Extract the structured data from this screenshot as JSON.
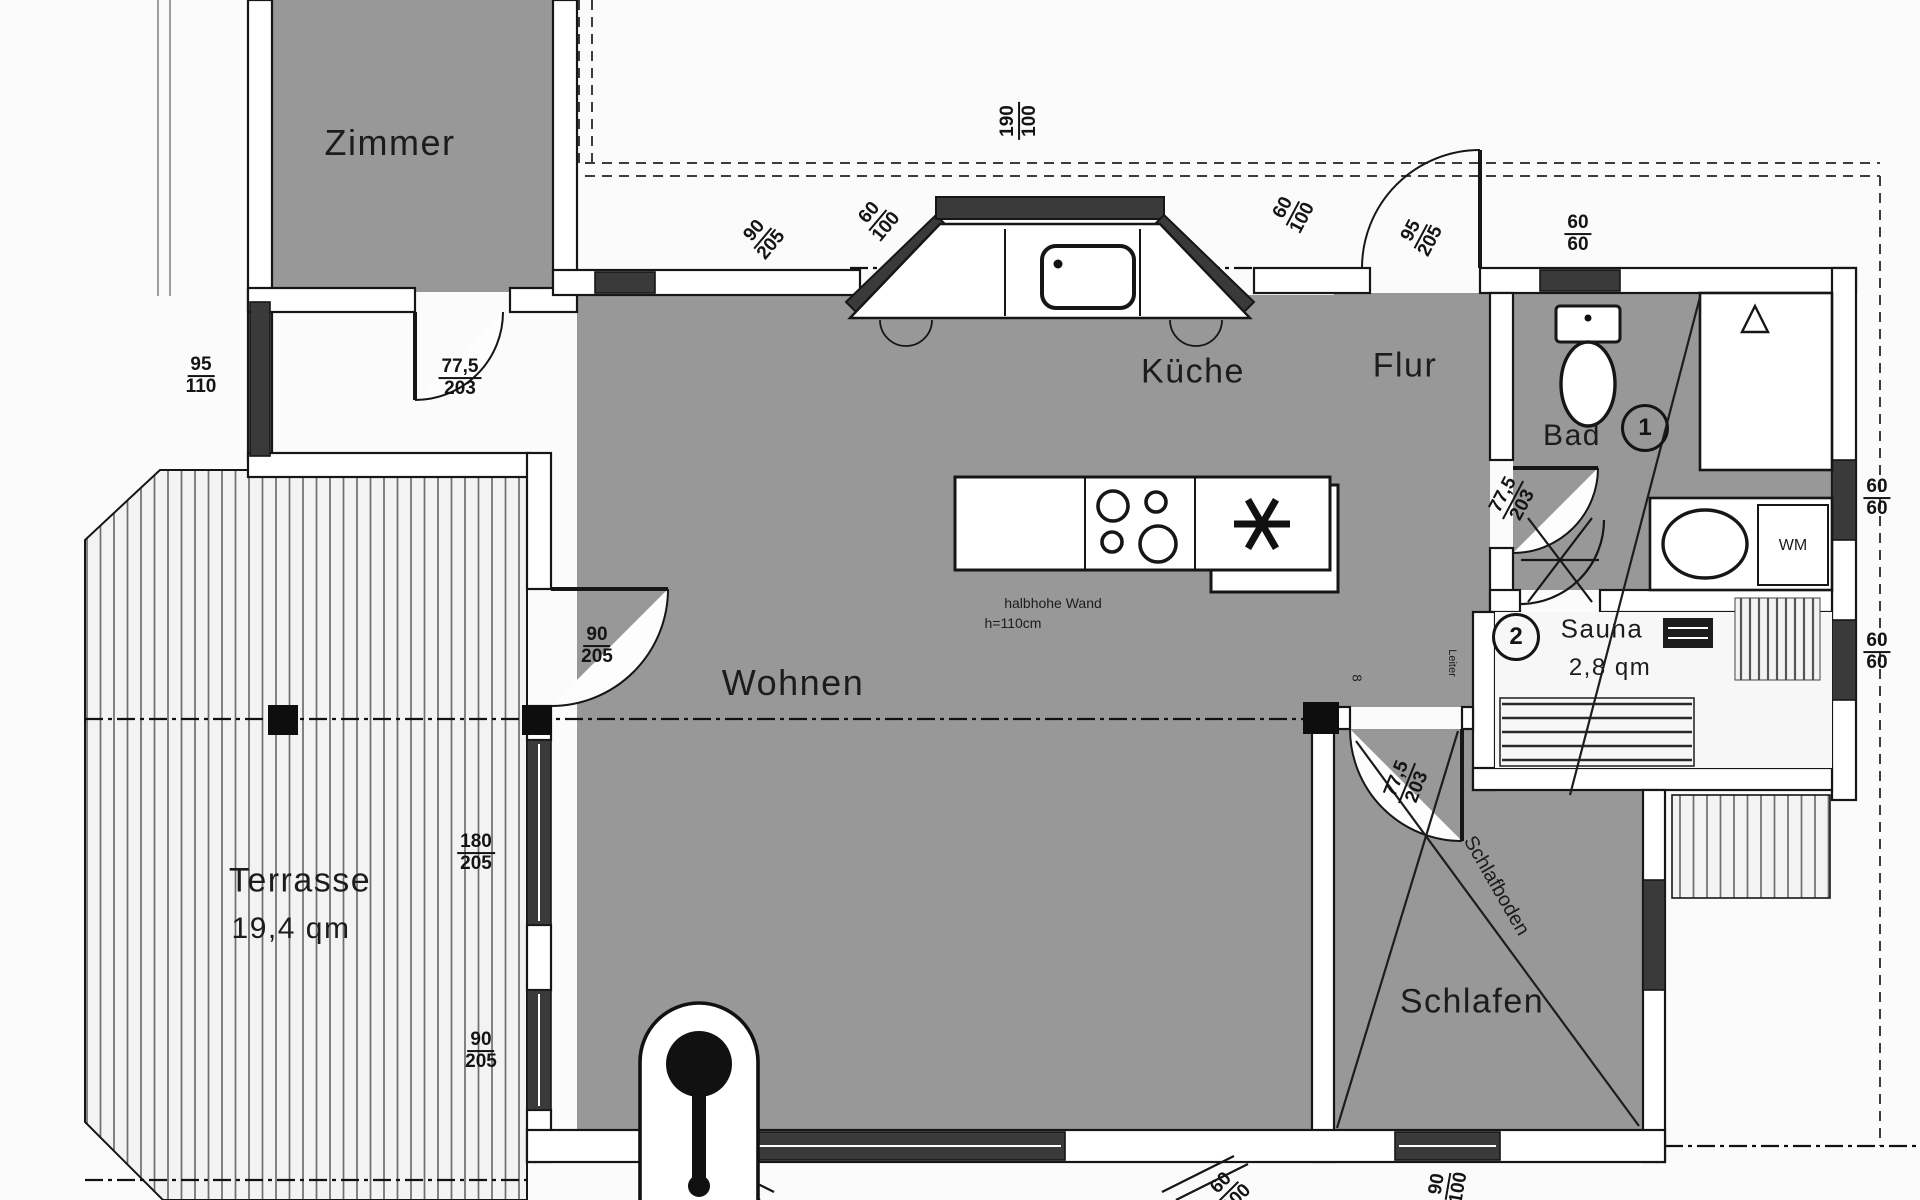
{
  "plan": {
    "colors": {
      "floor": "#989898",
      "wall_fill": "#ffffff",
      "line": "#161616",
      "window_fill": "#3a3a3a",
      "background": "#fbfbfb"
    },
    "rooms": [
      {
        "t": "Zimmer",
        "x": 390,
        "y": 143,
        "fs": 36
      },
      {
        "t": "Küche",
        "x": 1193,
        "y": 372,
        "fs": 34
      },
      {
        "t": "Flur",
        "x": 1405,
        "y": 366,
        "fs": 34
      },
      {
        "t": "Bad",
        "x": 1572,
        "y": 436,
        "fs": 30
      },
      {
        "t": "Wohnen",
        "x": 793,
        "y": 683,
        "fs": 36
      },
      {
        "t": "Schlafen",
        "x": 1472,
        "y": 1002,
        "fs": 34
      },
      {
        "t": "Terrasse",
        "x": 300,
        "y": 881,
        "fs": 34
      },
      {
        "t": "19,4 qm",
        "x": 291,
        "y": 929,
        "fs": 30
      },
      {
        "t": "Sauna",
        "x": 1602,
        "y": 629,
        "fs": 26
      },
      {
        "t": "2,8 qm",
        "x": 1610,
        "y": 668,
        "fs": 24
      }
    ],
    "dims": [
      {
        "n": "95",
        "d": "110",
        "x": 201,
        "y": 376,
        "r": 0
      },
      {
        "n": "77,5",
        "d": "203",
        "x": 460,
        "y": 378,
        "r": 0
      },
      {
        "n": "90",
        "d": "205",
        "x": 597,
        "y": 646,
        "r": 0
      },
      {
        "n": "180",
        "d": "205",
        "x": 476,
        "y": 853,
        "r": 0
      },
      {
        "n": "90",
        "d": "205",
        "x": 481,
        "y": 1051,
        "r": 0
      },
      {
        "n": "90",
        "d": "205",
        "x": 763,
        "y": 238,
        "r": -50
      },
      {
        "n": "60",
        "d": "100",
        "x": 878,
        "y": 220,
        "r": -50
      },
      {
        "n": "190",
        "d": "100",
        "x": 1019,
        "y": 121,
        "r": -90
      },
      {
        "n": "60",
        "d": "100",
        "x": 1293,
        "y": 213,
        "r": -62
      },
      {
        "n": "95",
        "d": "205",
        "x": 1421,
        "y": 236,
        "r": -62
      },
      {
        "n": "60",
        "d": "60",
        "x": 1578,
        "y": 234,
        "r": 0
      },
      {
        "n": "77,5",
        "d": "203",
        "x": 1513,
        "y": 500,
        "r": -62
      },
      {
        "n": "60",
        "d": "60",
        "x": 1877,
        "y": 498,
        "r": 0
      },
      {
        "n": "60",
        "d": "60",
        "x": 1877,
        "y": 652,
        "r": 0
      },
      {
        "n": "77,5",
        "d": "203",
        "x": 1407,
        "y": 783,
        "r": -68
      },
      {
        "n": "90",
        "d": "100",
        "x": 1448,
        "y": 1186,
        "r": -80
      },
      {
        "n": "60",
        "d": "100",
        "x": 1229,
        "y": 1191,
        "r": -45
      }
    ],
    "notes": [
      {
        "t": "halbhohe Wand",
        "x": 1053,
        "y": 603,
        "fs": 14
      },
      {
        "t": "h=110cm",
        "x": 1013,
        "y": 623,
        "fs": 14
      },
      {
        "t": "WM",
        "x": 1793,
        "y": 546,
        "fs": 16
      },
      {
        "t": "Schlafboden",
        "x": 1496,
        "y": 886,
        "fs": 20,
        "r": 60
      },
      {
        "t": "Leiter",
        "x": 1452,
        "y": 663,
        "fs": 11,
        "r": 90
      },
      {
        "t": "8",
        "x": 1357,
        "y": 678,
        "fs": 13,
        "r": 90
      }
    ],
    "circles": [
      {
        "t": "1",
        "x": 1645,
        "y": 428,
        "d": 42,
        "fs": 24
      },
      {
        "t": "2",
        "x": 1516,
        "y": 637,
        "d": 42,
        "fs": 24
      }
    ]
  }
}
